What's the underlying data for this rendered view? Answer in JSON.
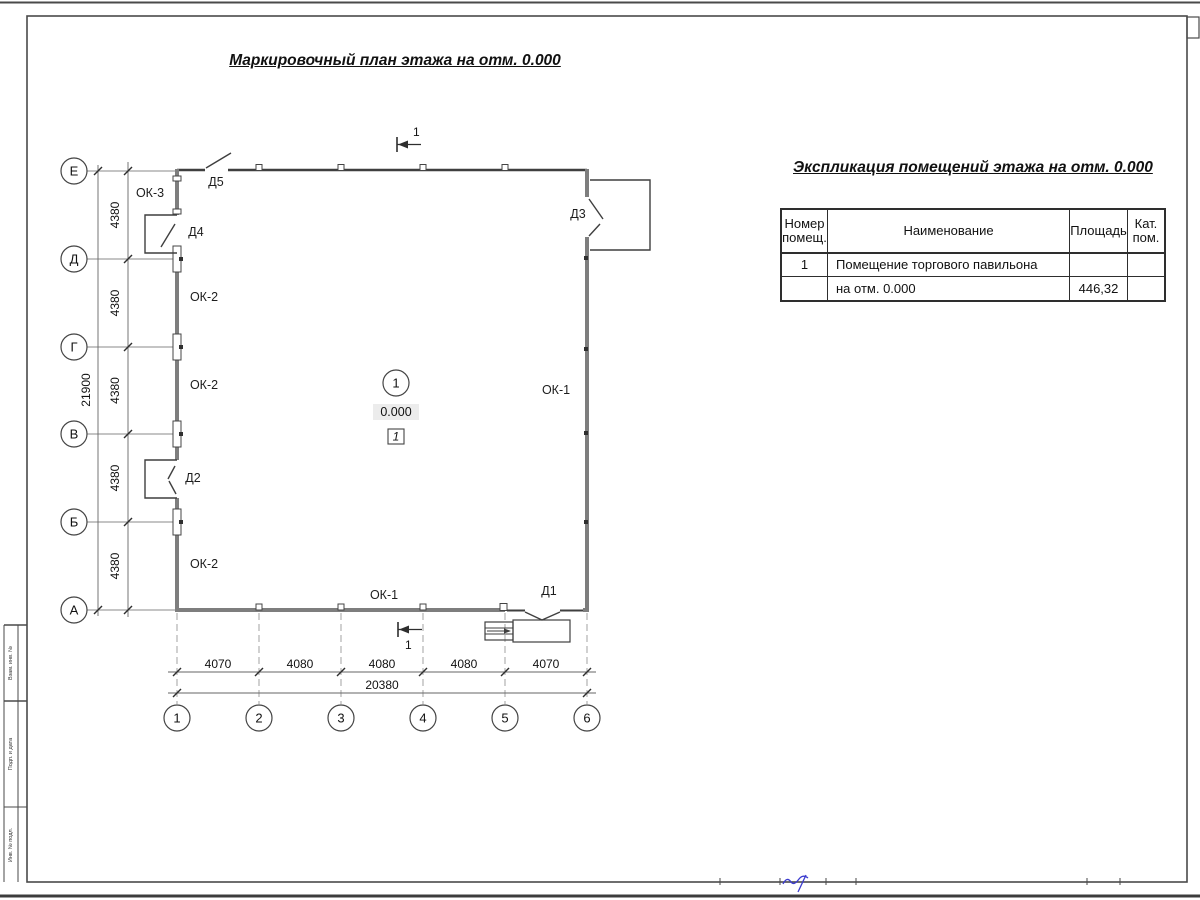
{
  "page": {
    "plan_title": "Маркировочный план этажа на отм. 0.000",
    "table_title": "Экспликация помещений этажа на отм. 0.000"
  },
  "plan": {
    "section_label": "1",
    "room_circle": "1",
    "elevation": "0.000",
    "room_box": "1",
    "row_axes": [
      "Е",
      "Д",
      "Г",
      "В",
      "Б",
      "А"
    ],
    "col_axes": [
      "1",
      "2",
      "3",
      "4",
      "5",
      "6"
    ],
    "left_dims": [
      "4380",
      "4380",
      "4380",
      "4380",
      "4380"
    ],
    "left_total": "21900",
    "bottom_dims": [
      "4070",
      "4080",
      "4080",
      "4080",
      "4070"
    ],
    "bottom_total": "20380",
    "openings": {
      "ok1": "ОК-1",
      "ok2": "ОК-2",
      "ok3": "ОК-3",
      "d1": "Д1",
      "d2": "Д2",
      "d3": "Д3",
      "d4": "Д4",
      "d5": "Д5"
    }
  },
  "table": {
    "header": {
      "num1": "Номер",
      "num2": "помещ.",
      "name": "Наименование",
      "area": "Площадь",
      "cat1": "Кат.",
      "cat2": "пом."
    },
    "rows": [
      {
        "num": "1",
        "name": "Помещение торгового павильона",
        "area": "",
        "cat": ""
      },
      {
        "num": "",
        "name": "на отм. 0.000",
        "area": "446,32",
        "cat": ""
      }
    ]
  },
  "frame": {
    "margin_labels": [
      "Взам. инв. №",
      "Подп. и дата",
      "Инв. № подл."
    ]
  }
}
